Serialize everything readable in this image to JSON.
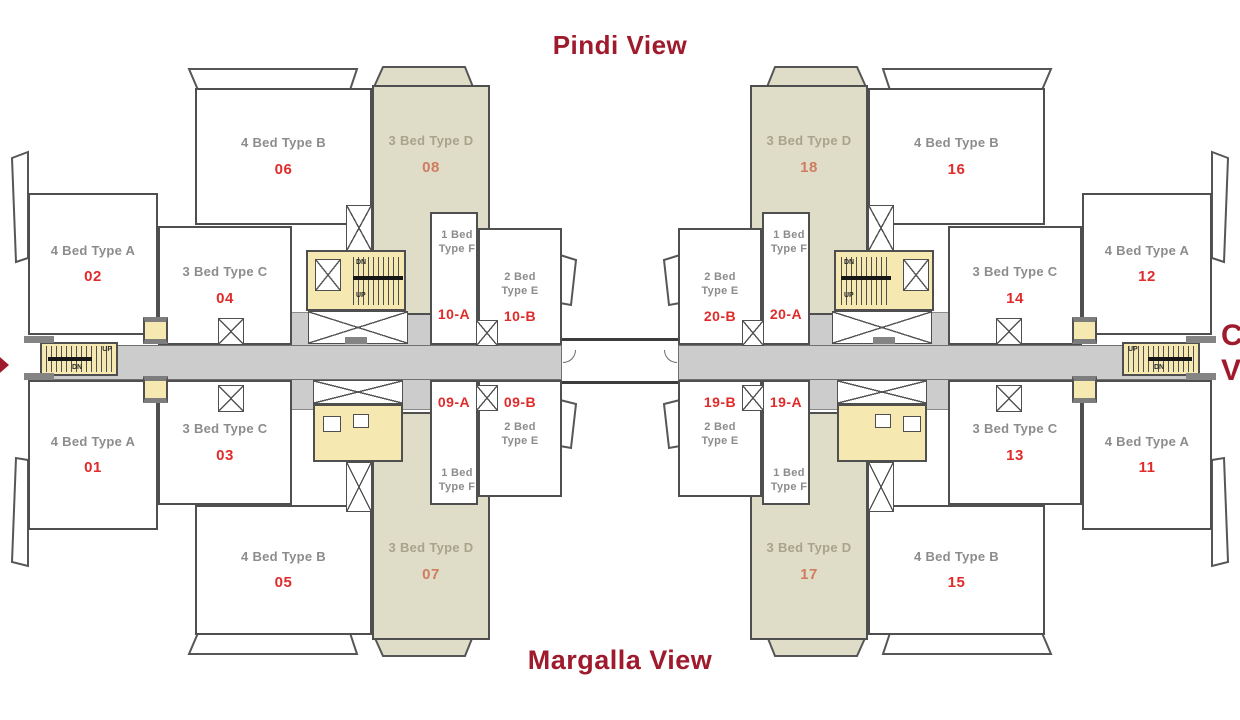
{
  "titles": {
    "top": "Pindi View",
    "bottom": "Margalla View"
  },
  "edge_labels": {
    "right_line1": "C",
    "right_line2": "V"
  },
  "stairs": {
    "up": "UP",
    "dn": "DN"
  },
  "colors": {
    "accent_red": "#9e1a2c",
    "unit_number_red": "#e02b2b",
    "beige_unit": "#dfdcc8",
    "core_yellow": "#f5e8b0",
    "corridor_gray": "#cccccc",
    "outline_gray": "#4f4f4f"
  },
  "units": [
    {
      "type": "4 Bed Type B",
      "number": "06"
    },
    {
      "type": "3 Bed Type D",
      "number": "08"
    },
    {
      "type": "4 Bed Type A",
      "number": "02"
    },
    {
      "type": "3 Bed Type C",
      "number": "04"
    },
    {
      "type": "1 Bed Type F",
      "number": "10-A"
    },
    {
      "type": "2 Bed Type E",
      "number": "10-B"
    },
    {
      "type": "1 Bed Type F",
      "number": "09-A"
    },
    {
      "type": "2 Bed Type E",
      "number": "09-B"
    },
    {
      "type": "3 Bed Type C",
      "number": "03"
    },
    {
      "type": "4 Bed Type A",
      "number": "01"
    },
    {
      "type": "4 Bed Type B",
      "number": "05"
    },
    {
      "type": "3 Bed Type D",
      "number": "07"
    },
    {
      "type": "3 Bed Type D",
      "number": "18"
    },
    {
      "type": "4 Bed Type B",
      "number": "16"
    },
    {
      "type": "2 Bed Type E",
      "number": "20-B"
    },
    {
      "type": "1 Bed Type F",
      "number": "20-A"
    },
    {
      "type": "2 Bed Type E",
      "number": "19-B"
    },
    {
      "type": "1 Bed Type F",
      "number": "19-A"
    },
    {
      "type": "3 Bed Type C",
      "number": "14"
    },
    {
      "type": "4 Bed Type A",
      "number": "12"
    },
    {
      "type": "3 Bed Type C",
      "number": "13"
    },
    {
      "type": "4 Bed Type A",
      "number": "11"
    },
    {
      "type": "3 Bed Type D",
      "number": "17"
    },
    {
      "type": "4 Bed Type B",
      "number": "15"
    }
  ]
}
